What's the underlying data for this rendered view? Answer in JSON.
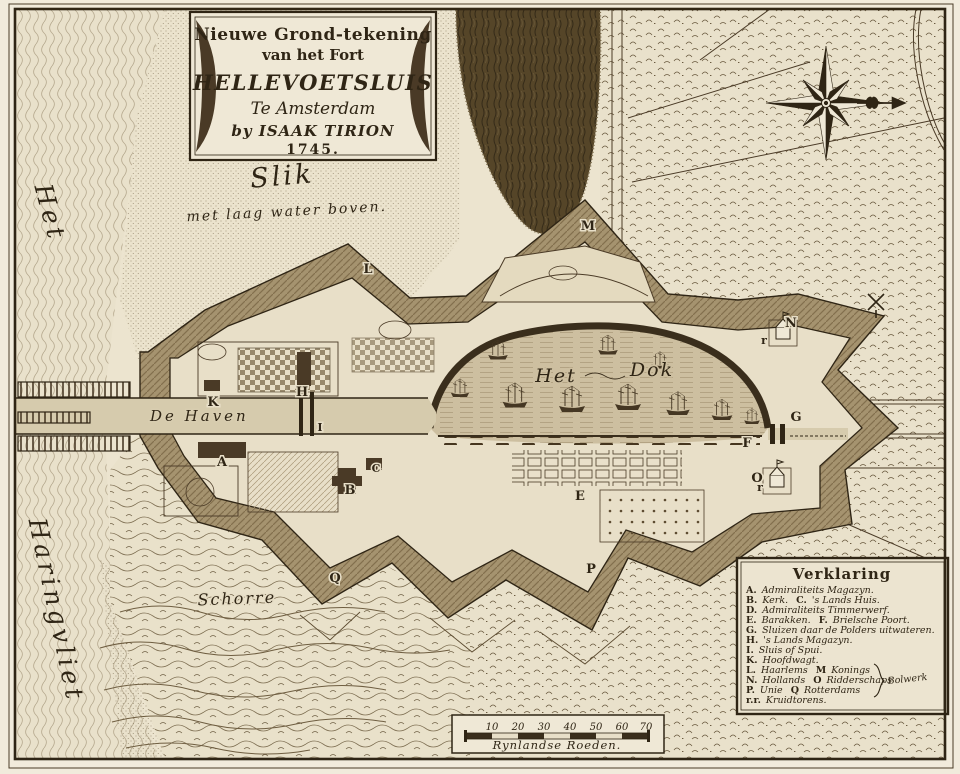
{
  "colors": {
    "paper": "#ece4cf",
    "ink": "#2f2515",
    "moat": "#a5936f",
    "water": "#8a7a5c"
  },
  "cartouche": {
    "line1": "Nieuwe Grond-tekening",
    "line2": "van het Fort",
    "line3": "HELLEVOETSLUIS",
    "line4": "Te Amsterdam",
    "line5": "by ISAAK TIRION",
    "line6": "1745."
  },
  "place_labels": {
    "slik": "Slik",
    "slik_sub": "met laag water boven.",
    "het": "Het",
    "haringvliet": "Haringvliet",
    "de_haven": "De Haven",
    "dok_het": "Het",
    "dok_dok": "Dok",
    "schorre": "Schorre"
  },
  "markers": {
    "A": "A",
    "B": "B",
    "C": "C",
    "E": "E",
    "F": "F",
    "G": "G",
    "H": "H",
    "I": "I",
    "K": "K",
    "L": "L",
    "M": "M",
    "N": "N",
    "O": "O",
    "P": "P",
    "Q": "Q",
    "r": "r"
  },
  "legend": {
    "title": "Verklaring",
    "entries": [
      {
        "key": "A.",
        "desc": "Admiraliteits Magazyn."
      },
      {
        "key": "B.",
        "desc": "Kerk.",
        "key2": "C.",
        "desc2": "'s Lands Huis."
      },
      {
        "key": "D.",
        "desc": "Admiraliteits Timmerwerf."
      },
      {
        "key": "E.",
        "desc": "Barakken.",
        "key2": "F.",
        "desc2": "Brielsche Poort."
      },
      {
        "key": "G.",
        "desc": "Sluizen daar de Polders uitwateren."
      },
      {
        "key": "H.",
        "desc": "'s Lands Magazyn."
      },
      {
        "key": "I.",
        "desc": "Sluis of Spui."
      },
      {
        "key": "K.",
        "desc": "Hoofdwagt."
      },
      {
        "key": "L.",
        "desc": "Haarlems",
        "key2": "M",
        "desc2": "Konings"
      },
      {
        "key": "N.",
        "desc": "Hollands",
        "key2": "O",
        "desc2": "Ridderschaps"
      },
      {
        "key": "P.",
        "desc": "Unie",
        "key2": "Q",
        "desc2": "Rotterdams"
      },
      {
        "key": "r.r.",
        "desc": "Kruidtorens."
      }
    ],
    "brace_label": "Bolwerk"
  },
  "scale_bar": {
    "ticks": [
      "10",
      "20",
      "30",
      "40",
      "50",
      "60",
      "70"
    ],
    "unit": "Rynlandse Roeden."
  }
}
